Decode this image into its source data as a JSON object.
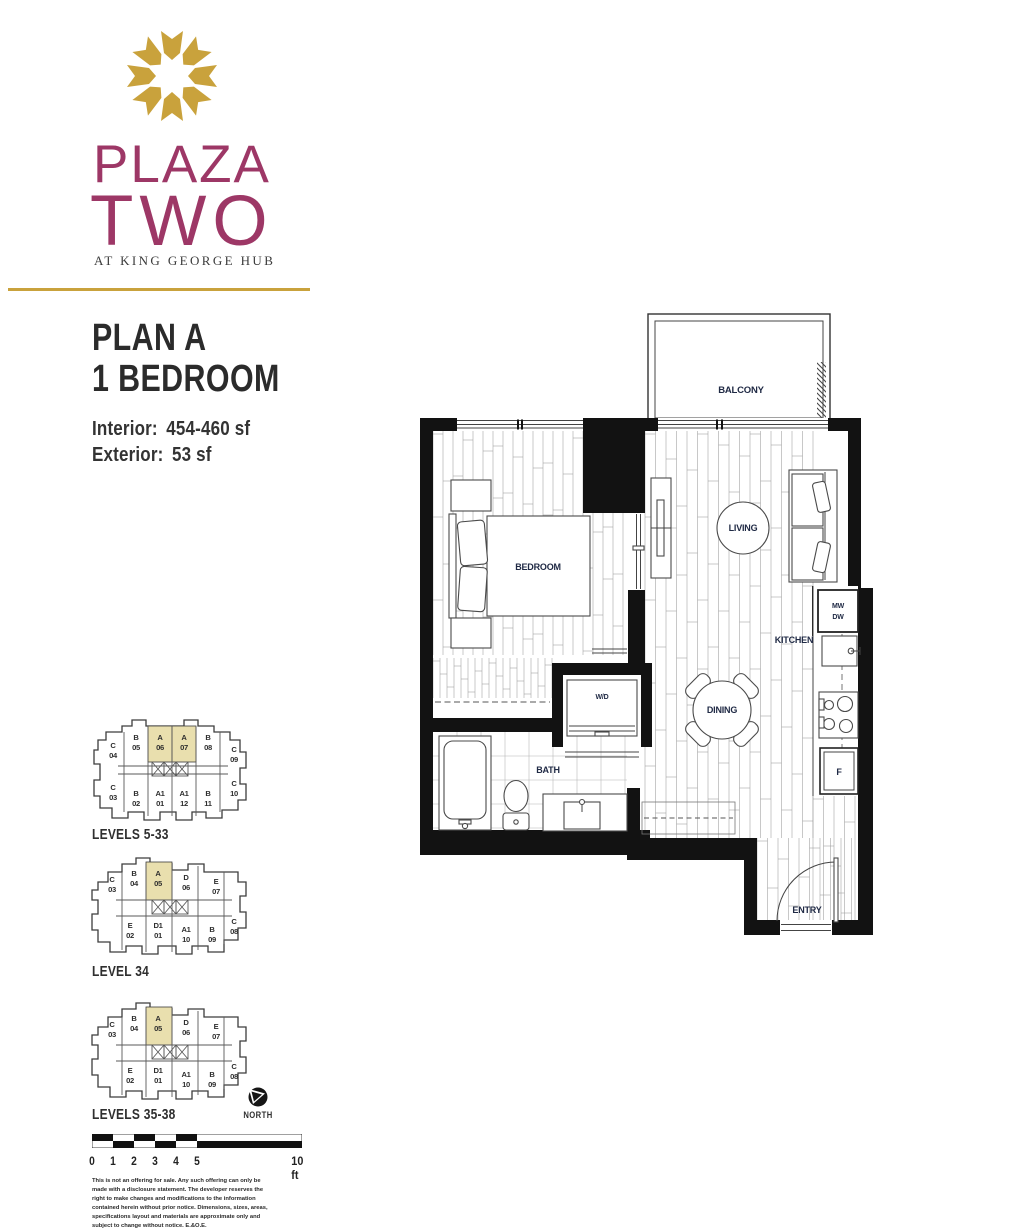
{
  "logo": {
    "plaza": "PLAZA",
    "two": "TWO",
    "tagline": "AT KING GEORGE HUB",
    "mark": "starburst-icon"
  },
  "plan": {
    "title_line1": "PLAN A",
    "title_line2": "1 BEDROOM",
    "interior_label": "Interior:",
    "interior_value": "454-460 sf",
    "exterior_label": "Exterior:",
    "exterior_value": "53 sf"
  },
  "floorplan": {
    "rooms": {
      "balcony": "BALCONY",
      "living": "LIVING",
      "bedroom": "BEDROOM",
      "kitchen": "KITCHEN",
      "dining": "DINING",
      "bath": "BATH",
      "entry": "ENTRY",
      "wd": "W/D",
      "mw": "MW",
      "dw": "DW",
      "fridge": "F"
    }
  },
  "keyplans": [
    {
      "label": "LEVELS 5-33",
      "units": [
        {
          "letter": "C",
          "number": "04"
        },
        {
          "letter": "B",
          "number": "05"
        },
        {
          "letter": "A",
          "number": "06",
          "highlighted": true
        },
        {
          "letter": "A",
          "number": "07",
          "highlighted": true
        },
        {
          "letter": "B",
          "number": "08"
        },
        {
          "letter": "C",
          "number": "09"
        },
        {
          "letter": "C",
          "number": "03"
        },
        {
          "letter": "B",
          "number": "02"
        },
        {
          "letter": "A1",
          "number": "01"
        },
        {
          "letter": "A1",
          "number": "12"
        },
        {
          "letter": "B",
          "number": "11"
        },
        {
          "letter": "C",
          "number": "10"
        }
      ]
    },
    {
      "label": "LEVEL 34",
      "units": [
        {
          "letter": "C",
          "number": "03"
        },
        {
          "letter": "B",
          "number": "04"
        },
        {
          "letter": "A",
          "number": "05",
          "highlighted": true
        },
        {
          "letter": "D",
          "number": "06"
        },
        {
          "letter": "E",
          "number": "07"
        },
        {
          "letter": "E",
          "number": "02"
        },
        {
          "letter": "D1",
          "number": "01"
        },
        {
          "letter": "A1",
          "number": "10"
        },
        {
          "letter": "B",
          "number": "09"
        },
        {
          "letter": "C",
          "number": "08"
        }
      ]
    },
    {
      "label": "LEVELS 35-38",
      "units": [
        {
          "letter": "C",
          "number": "03"
        },
        {
          "letter": "B",
          "number": "04"
        },
        {
          "letter": "A",
          "number": "05",
          "highlighted": true
        },
        {
          "letter": "D",
          "number": "06"
        },
        {
          "letter": "E",
          "number": "07"
        },
        {
          "letter": "E",
          "number": "02"
        },
        {
          "letter": "D1",
          "number": "01"
        },
        {
          "letter": "A1",
          "number": "10"
        },
        {
          "letter": "B",
          "number": "09"
        },
        {
          "letter": "C",
          "number": "08"
        }
      ]
    }
  ],
  "north_label": "NORTH",
  "scalebar": {
    "ticks": [
      "0",
      "1",
      "2",
      "3",
      "4",
      "5"
    ],
    "end_label": "10 ft"
  },
  "disclaimer": "This is not an offering for sale. Any such offering can only be made with a disclosure statement. The developer reserves the right to make changes and modifications to the information contained herein without prior notice. Dimensions, sizes, areas, specifications layout and materials are approximate only and subject to change without notice. E.&O.E.",
  "colors": {
    "magenta": "#9d3766",
    "gold": "#c9a23c",
    "navy": "#202a45",
    "highlight": "#e9dfae",
    "wall": "#121212"
  }
}
